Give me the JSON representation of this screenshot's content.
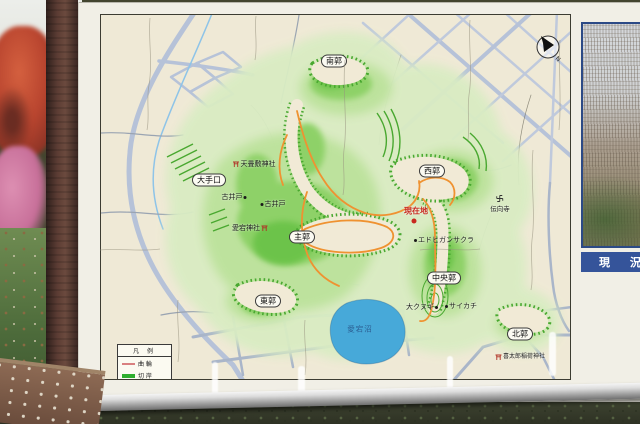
{
  "map": {
    "enclosure_labels": [
      {
        "label": "南郭"
      },
      {
        "label": "西郭"
      },
      {
        "label": "大手口"
      },
      {
        "label": "主郭"
      },
      {
        "label": "東郭"
      },
      {
        "label": "中央郭"
      },
      {
        "label": "北郭"
      }
    ],
    "poi_labels": {
      "shrine_top": "天畳敷神社",
      "old_well_west": "古井戸",
      "old_well_east": "古井戸",
      "atago_shrine": "愛宕神社",
      "edohigan_sakura": "エドヒガンサクラ",
      "temple": "伝向寺",
      "big_oak": "大クヌギ",
      "saikachi_tree": "サイカチ",
      "kitaro_inari_shrine": "喜太郎稲荷神社"
    },
    "current_location_label": "現在地",
    "lake_label": "愛宕沼",
    "legend": {
      "title": "凡 例",
      "items": [
        {
          "label": "曲 輪",
          "color": "#d98080"
        },
        {
          "label": "切 岸",
          "color": "#2fae2f"
        },
        {
          "label": "散策路",
          "color": "#f09130"
        }
      ]
    },
    "compass_label": "N"
  },
  "side_panel": {
    "header": "現 況",
    "vertical_text_columns": [
      "郭となっている。",
      "この山城には、主郭である",
      "愛宕山頂を中心に、階段状で",
      "ある切岸（人工の崖）によって",
      "囲まれた曲輪（平坦地）がいた",
      "るところに残り、県内では最大",
      "規模の戦国期山城である。"
    ]
  },
  "colors": {
    "trail_orange": "#f09130",
    "cliff_green": "#2fae2f",
    "lake_blue": "#47a9d9",
    "current_location_red": "#d03028",
    "panel_header_blue": "#35549a"
  }
}
